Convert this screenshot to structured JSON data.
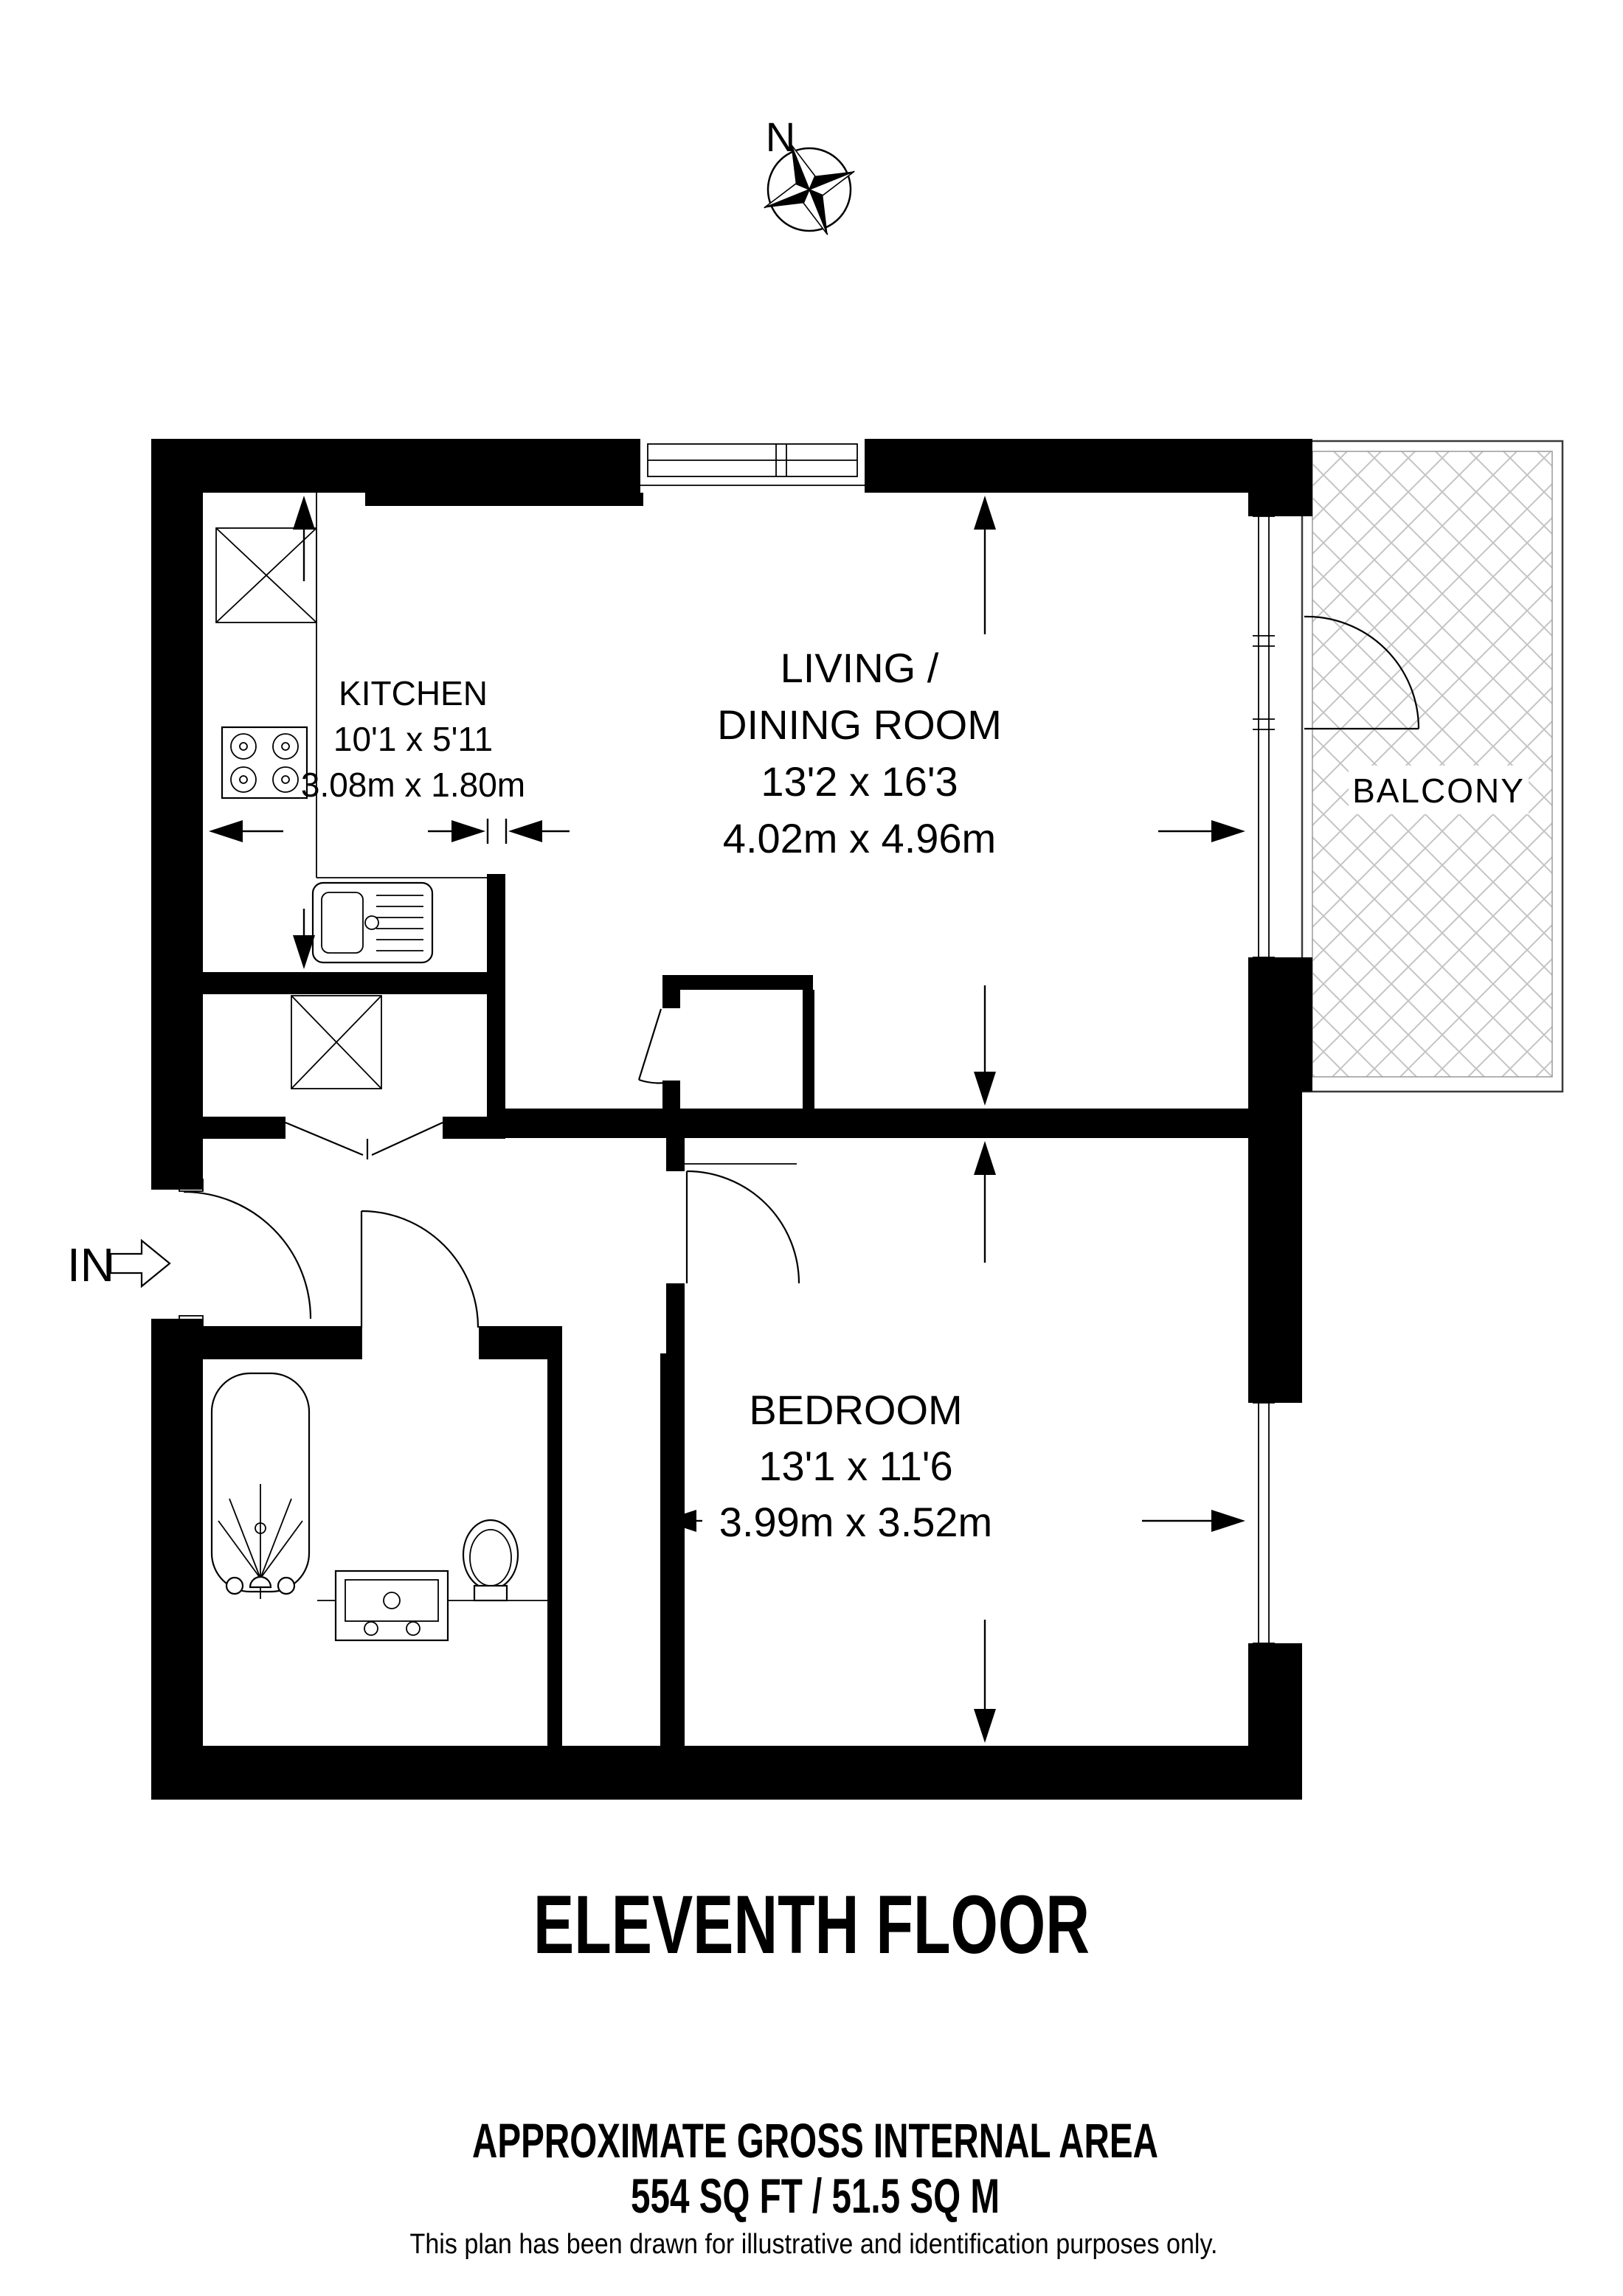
{
  "compass": {
    "north_label": "N"
  },
  "entrance": {
    "label": "IN"
  },
  "rooms": {
    "kitchen": {
      "name": "KITCHEN",
      "dimensions_imperial": "10'1 x 5'11",
      "dimensions_metric": "3.08m x 1.80m"
    },
    "living_dining": {
      "name_line1": "LIVING /",
      "name_line2": "DINING ROOM",
      "dimensions_imperial": "13'2 x 16'3",
      "dimensions_metric": "4.02m x 4.96m"
    },
    "bedroom": {
      "name": "BEDROOM",
      "dimensions_imperial": "13'1 x 11'6",
      "dimensions_metric": "3.99m x 3.52m"
    },
    "balcony": {
      "name": "BALCONY"
    }
  },
  "floor_title": "ELEVENTH FLOOR",
  "footer": {
    "area_heading": "APPROXIMATE GROSS INTERNAL AREA",
    "area_value": "554 SQ FT / 51.5 SQ M",
    "disclaimer": "This plan has been drawn for illustrative and identification purposes only."
  },
  "colors": {
    "walls": "#000000",
    "hatch": "#c4c4c4",
    "background": "#ffffff"
  }
}
